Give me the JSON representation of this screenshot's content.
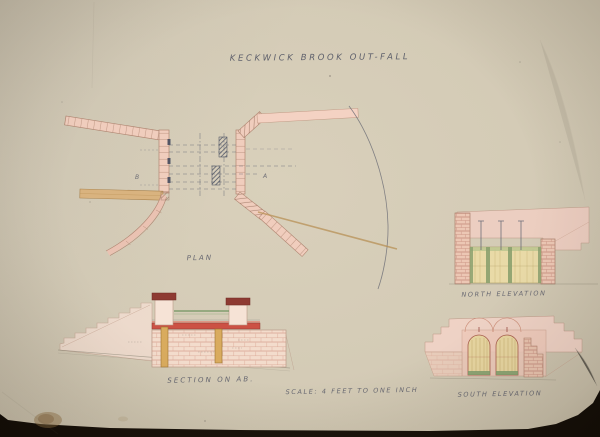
{
  "title": "KECKWICK BROOK OUT-FALL",
  "views": {
    "plan": {
      "label": "PLAN"
    },
    "section": {
      "label": "SECTION ON AB."
    },
    "north_elevation": {
      "label": "NORTH ELEVATION"
    },
    "south_elevation": {
      "label": "SOUTH ELEVATION"
    }
  },
  "scale_note": "SCALE: 4 FEET TO ONE INCH",
  "markers": {
    "a": "A",
    "b": "B"
  },
  "palette": {
    "backdrop": "#1a130b",
    "paper": "#d4cbb6",
    "ink": "#565866",
    "wall_pink": "#f0cdbd",
    "wall_outline": "#b08672",
    "timber_ochre": "#d9ab5e",
    "deck_red": "#cc5144",
    "cap_dark_red": "#8e3a32",
    "water_green": "#5f8a50",
    "gate_yellow": "#e8d9a0",
    "brick_line": "#c4897a"
  }
}
